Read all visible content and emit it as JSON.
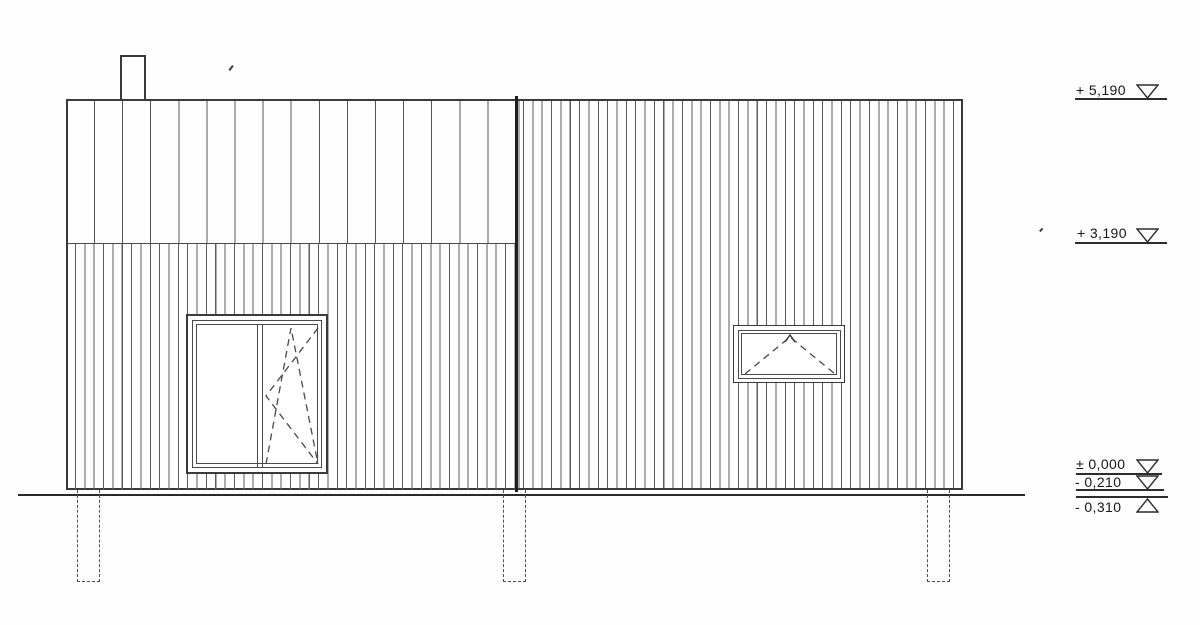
{
  "drawing": {
    "kind": "building-elevation",
    "colors": {
      "background": "#fefefe",
      "thin_line": "#5c5c5c",
      "outline": "#3a3a3a",
      "heavy_line": "#1d1d1d",
      "text": "#161616"
    },
    "levels": [
      {
        "label": "+ 5,190",
        "marker": "triangle-down"
      },
      {
        "label": "+ 3,190",
        "marker": "triangle-down"
      },
      {
        "label": "± 0,000",
        "marker": "triangle-down"
      },
      {
        "label": "- 0,210",
        "marker": "triangle-down"
      },
      {
        "label": "- 0,310",
        "marker": "triangle-up"
      }
    ],
    "facade": {
      "left_block": {
        "upper_cladding": "wide-vertical-boards",
        "lower_cladding": "narrow-vertical-boards",
        "features": [
          "chimney",
          "two-pane-window"
        ]
      },
      "right_block": {
        "cladding": "narrow-vertical-boards",
        "features": [
          "tilt-window"
        ]
      },
      "windows": [
        {
          "name": "left-window",
          "panes": 2,
          "opening": "right sash tilt-and-turn (dashed symbol)"
        },
        {
          "name": "right-window",
          "panes": 1,
          "opening": "bottom-hinged tilt (dashed symbol)"
        }
      ],
      "foundation_piers": 3,
      "ground_line": true
    }
  }
}
